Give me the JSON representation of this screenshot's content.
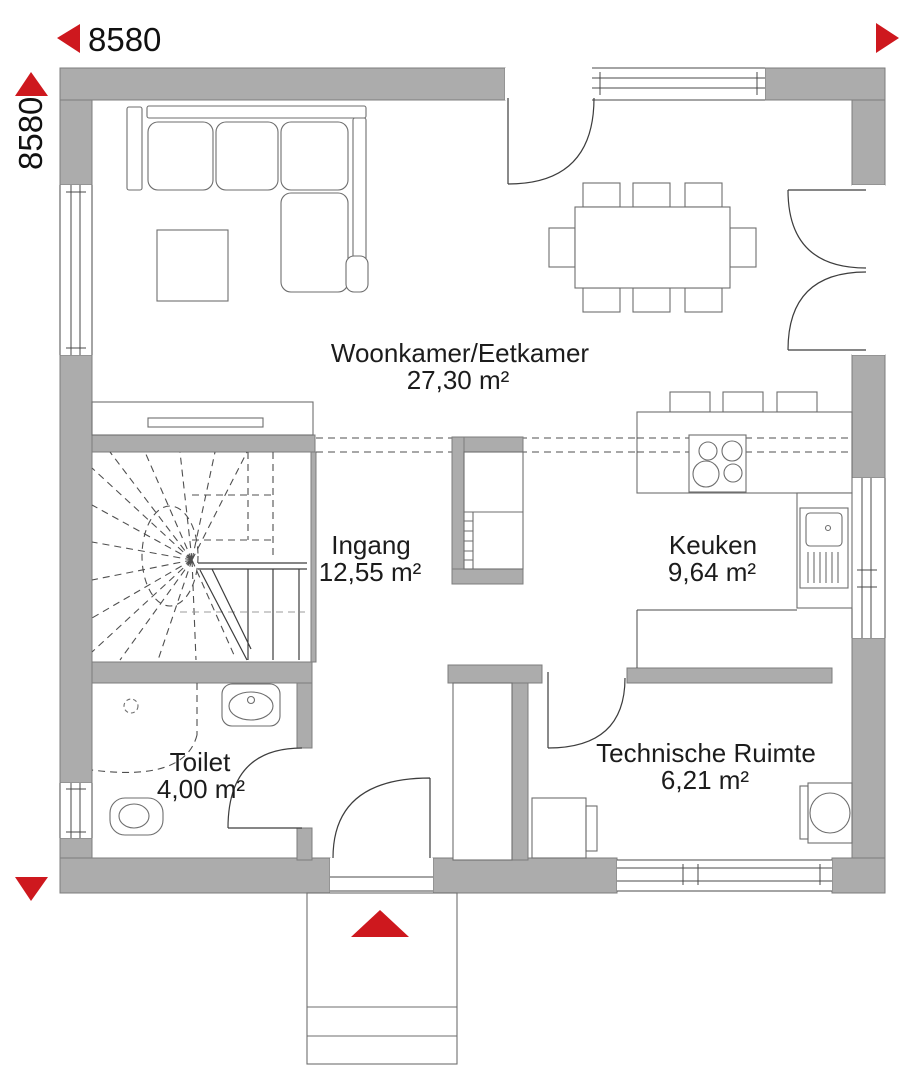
{
  "dimensions": {
    "width_label": "8580",
    "height_label": "8580"
  },
  "rooms": {
    "living": {
      "name": "Woonkamer/Eetkamer",
      "area": "27,30 m²"
    },
    "entrance": {
      "name": "Ingang",
      "area": "12,55 m²"
    },
    "kitchen": {
      "name": "Keuken",
      "area": "9,64 m²"
    },
    "toilet": {
      "name": "Toilet",
      "area": "4,00 m²"
    },
    "technical": {
      "name": "Technische Ruimte",
      "area": "6,21 m²"
    }
  },
  "colors": {
    "accent": "#ce181e",
    "wall": "#acacac",
    "line": "#4a4a4a",
    "text": "#1c1c1c"
  }
}
